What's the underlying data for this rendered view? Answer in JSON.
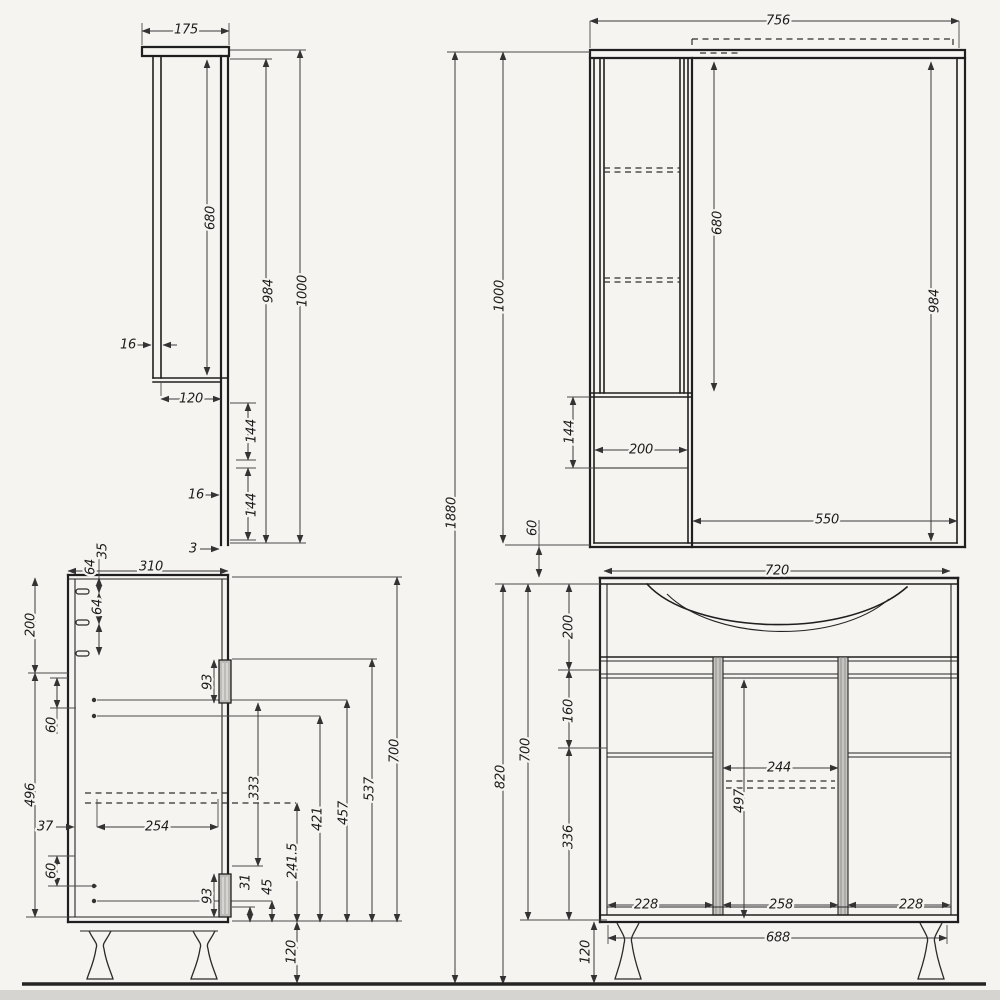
{
  "meta": {
    "background": "#f5f4f1",
    "line_color": "#1f1f1f",
    "dimension_color": "#3a3a3a",
    "text_color": "#1c1c1c",
    "ground_color": "#242424",
    "hardware_fill": "#bdbbb7",
    "pilaster_fill": "#c6c4c0"
  },
  "dims": {
    "ms_top_depth": "175",
    "ms_inner_height": "680",
    "ms_door_thickness": "16",
    "ms_body_depth": "120",
    "ms_gap_upper": "144",
    "ms_back_thickness": "16",
    "ms_gap_lower": "144",
    "ms_panel_thickness": "3",
    "ms_height_no_top": "984",
    "ms_total_height": "1000",
    "mf_total_width": "756",
    "mf_inner_height": "680",
    "mf_height_no_top": "984",
    "mf_total_height": "1000",
    "mf_shelf_gap": "144",
    "mf_side_cabinet_width": "200",
    "mf_mirror_width": "550",
    "ov_total_height": "1880",
    "ov_gap": "60",
    "vs_depth": "310",
    "vs_peg_offset": "35",
    "vs_peg_gap1": "64",
    "vs_peg_gap2": "64",
    "vs_top_section": "200",
    "vs_lower_section": "496",
    "vs_gap_upper": "60",
    "vs_gap_lower": "60",
    "vs_front_offset": "37",
    "vs_slide_length": "254",
    "vs_hinge_upper": "93",
    "vs_hinge_lower": "93",
    "vs_h333": "333",
    "vs_h241_5": "241.5",
    "vs_h31": "31",
    "vs_h45": "45",
    "vs_h421": "421",
    "vs_h457": "457",
    "vs_h537": "537",
    "vs_height": "700",
    "vs_leg_height": "120",
    "vf_sink_width": "720",
    "vf_total_height": "820",
    "vf_height": "700",
    "vf_top_section": "200",
    "vf_mid_section": "160",
    "vf_bottom_section": "336",
    "vf_drawer_width": "244",
    "vf_h497": "497",
    "vf_door_left": "228",
    "vf_drawer_front": "258",
    "vf_door_right": "228",
    "vf_base_width": "688",
    "vf_leg_height": "120"
  }
}
